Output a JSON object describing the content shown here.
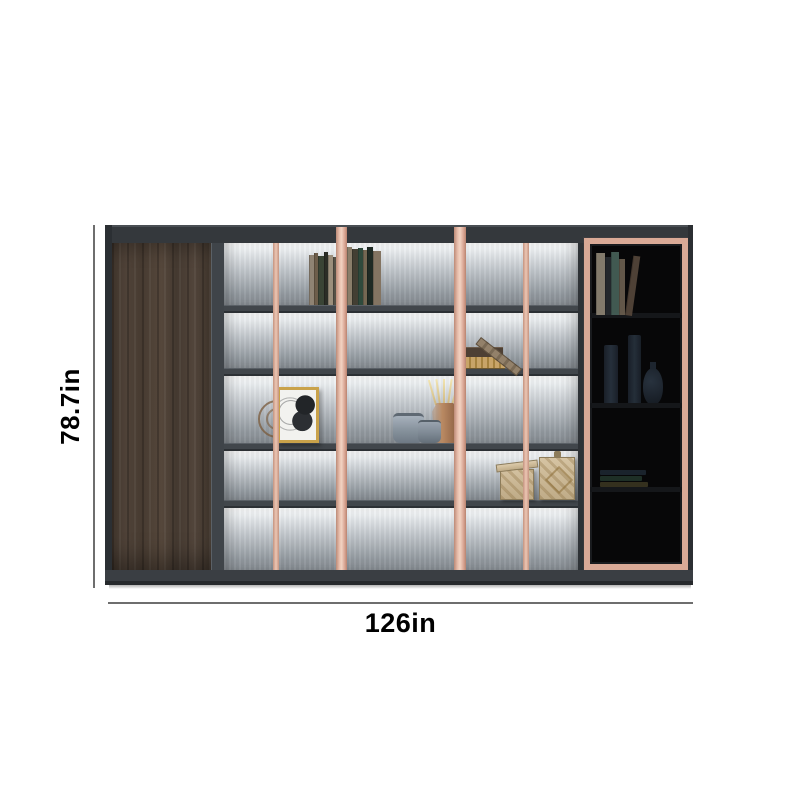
{
  "dimensions": {
    "height_label": "78.7in",
    "width_label": "126in"
  },
  "product": {
    "type": "bookcase-wall-cabinet",
    "modules": [
      "wood-door-cabinet",
      "open-shelving-3-bays-5-rows",
      "glass-door-display-cabinet"
    ],
    "colors": {
      "frame_dark_gray": "#34383c",
      "copper_accent": "#e7bdab",
      "wood_door_brown": "#4a3e33",
      "shelf_backlight_white": "#ffffff",
      "shelf_back_gray": "#90979d",
      "shelf_board_gray": "#41464b",
      "glass_tint_black": "#070708",
      "dimension_line_gray": "#6e6e6e",
      "dimension_text_black": "#000000"
    }
  },
  "decor": {
    "shelf_books_top": [
      {
        "w": 5,
        "h": 50,
        "c": "#8f8373"
      },
      {
        "w": 4,
        "h": 52,
        "c": "#6d5d4a"
      },
      {
        "w": 6,
        "h": 49,
        "c": "#3a4435"
      },
      {
        "w": 4,
        "h": 53,
        "c": "#2b2d26"
      },
      {
        "w": 5,
        "h": 50,
        "c": "#9c8f7c"
      },
      {
        "w": 4,
        "h": 48,
        "c": "#575247"
      },
      {
        "w": 11,
        "h": 0,
        "c": "transparent"
      },
      {
        "w": 5,
        "h": 58,
        "c": "#8a7e6a"
      },
      {
        "w": 6,
        "h": 56,
        "c": "#433f33"
      },
      {
        "w": 5,
        "h": 57,
        "c": "#2f4a3c"
      },
      {
        "w": 4,
        "h": 55,
        "c": "#746853"
      },
      {
        "w": 6,
        "h": 58,
        "c": "#1f2a24"
      },
      {
        "w": 8,
        "h": 54,
        "c": "#837462"
      }
    ],
    "glass_books_top": [
      {
        "w": 9,
        "h": 62,
        "c": "#8d8474"
      },
      {
        "w": 6,
        "h": 58,
        "c": "#262a2e"
      },
      {
        "w": 8,
        "h": 63,
        "c": "#466058"
      },
      {
        "w": 6,
        "h": 56,
        "c": "#6a5e4f"
      },
      {
        "w": 7,
        "h": 60,
        "c": "#55463a",
        "lean": 8
      }
    ],
    "glass_books_low": [
      {
        "w": 46,
        "h": 5,
        "c": "#2a3a4a"
      },
      {
        "w": 42,
        "h": 5,
        "c": "#31503f"
      },
      {
        "w": 48,
        "h": 5,
        "c": "#5a5330"
      }
    ],
    "diffuser_sticks": [
      {
        "x": 0,
        "rot": -16
      },
      {
        "x": 4,
        "rot": -8
      },
      {
        "x": 8,
        "rot": 0
      },
      {
        "x": 12,
        "rot": 8
      },
      {
        "x": 16,
        "rot": 16
      }
    ]
  }
}
